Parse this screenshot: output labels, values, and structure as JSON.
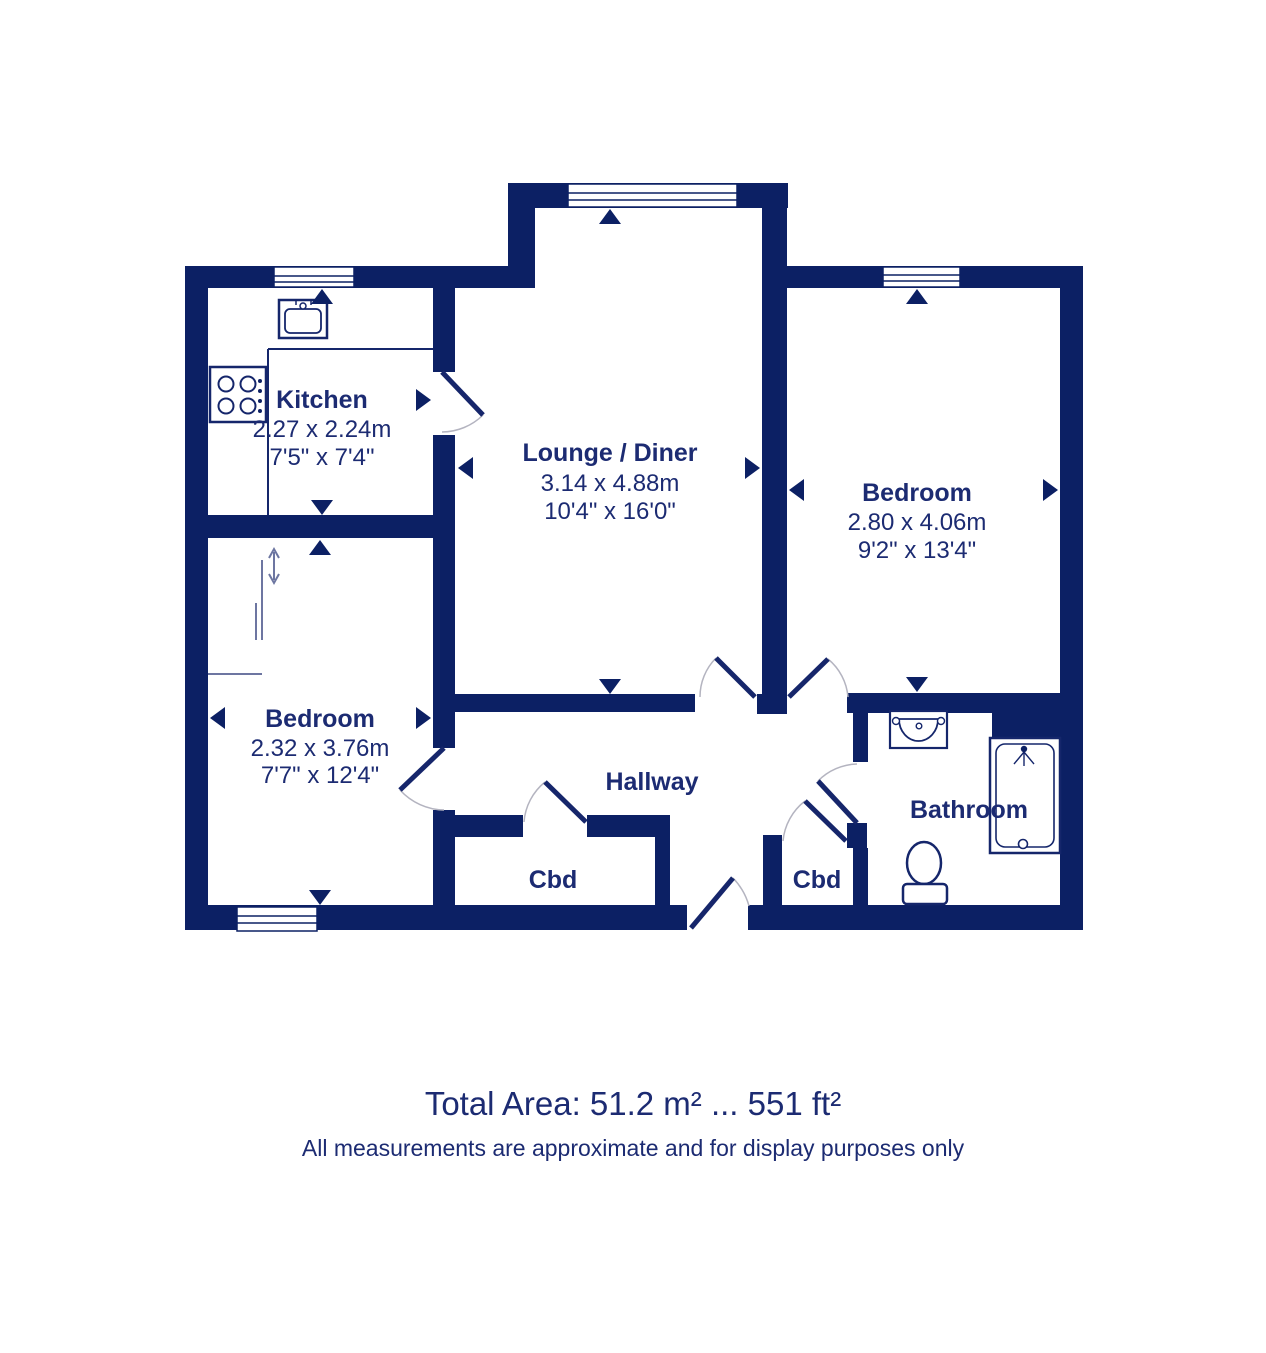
{
  "theme": {
    "wall_color": "#0c2064",
    "door_color": "#16266b",
    "text_color": "#1c2b72",
    "fixture_color": "#15266b",
    "arc_color": "#b4b4c0",
    "thin_line_color": "#6d76a1",
    "background_color": "#ffffff"
  },
  "rooms": {
    "kitchen": {
      "name": "Kitchen",
      "dim_m": "2.27 x 2.24m",
      "dim_ft": "7'5\" x 7'4\""
    },
    "lounge": {
      "name": "Lounge / Diner",
      "dim_m": "3.14 x 4.88m",
      "dim_ft": "10'4\" x 16'0\""
    },
    "bedroom_right": {
      "name": "Bedroom",
      "dim_m": "2.80 x 4.06m",
      "dim_ft": "9'2\" x 13'4\""
    },
    "bedroom_left": {
      "name": "Bedroom",
      "dim_m": "2.32 x 3.76m",
      "dim_ft": "7'7\" x 12'4\""
    },
    "hallway": {
      "name": "Hallway"
    },
    "cupboard_left": {
      "name": "Cbd"
    },
    "cupboard_right": {
      "name": "Cbd"
    },
    "bathroom": {
      "name": "Bathroom"
    }
  },
  "footer": {
    "total_area": "Total Area: 51.2 m² ... 551 ft²",
    "disclaimer": "All measurements are approximate and for display purposes only"
  }
}
